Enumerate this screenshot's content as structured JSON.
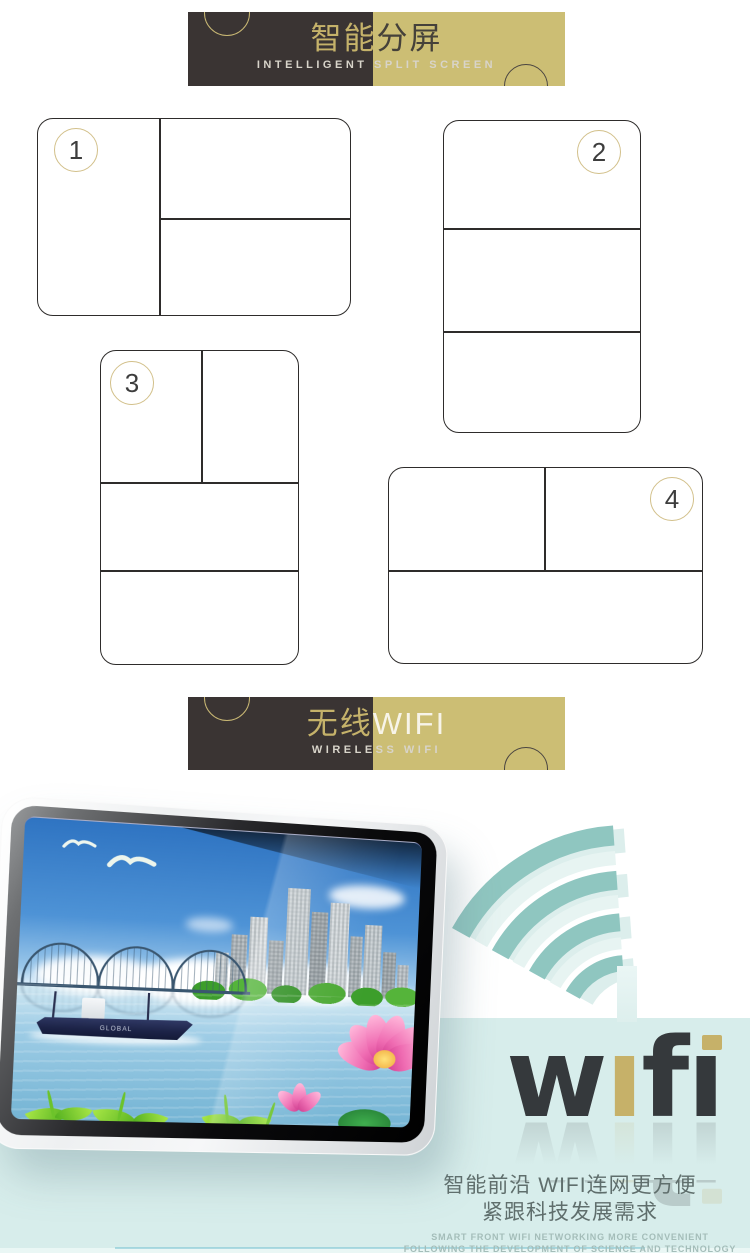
{
  "banner_split": {
    "title_part1": "智能",
    "title_part2": "分屏",
    "subtitle": "INTELLIGENT SPLIT SCREEN"
  },
  "banner_wifi": {
    "title_part1": "无线",
    "title_part2": "WIFI",
    "subtitle": "WIRELESS WIFI"
  },
  "layout_numbers": [
    "1",
    "2",
    "3",
    "4"
  ],
  "monitor": {
    "ship_label": "GLOBAL"
  },
  "wifi_logo": {
    "word": "wifi",
    "glyphs": [
      "w",
      "ı",
      "f",
      "ı"
    ]
  },
  "footer": {
    "cn_line1": "智能前沿 WIFI连网更方便",
    "cn_line2": "紧跟科技发展需求",
    "en_line1": "SMART FRONT WIFI NETWORKING MORE CONVENIENT",
    "en_line2": "FOLLOWING THE DEVELOPMENT OF SCIENCE AND TECHNOLOGY REQUIREMENTS"
  },
  "colors": {
    "banner_dark": "#3a3433",
    "banner_gold": "#ccbe74",
    "accent_gold": "#c5b26a",
    "band_teal": "#d7edeb",
    "wifi_arc_teal": "#8fc6c0",
    "wifi_arc_pale": "#dceeec",
    "logo_dark": "#35393c",
    "logo_gold": "#c6b169"
  }
}
